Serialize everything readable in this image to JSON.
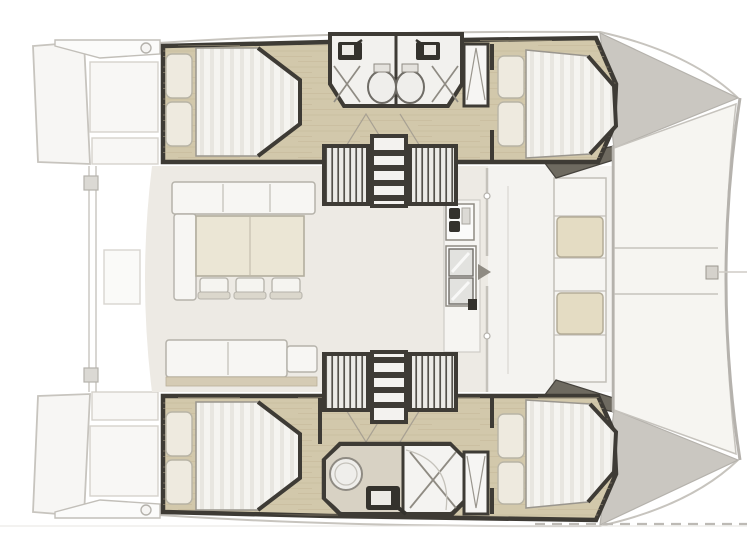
{
  "page": {
    "width": 747,
    "height": 560,
    "background": "#ffffff"
  },
  "palette": {
    "wall": "#3e3b35",
    "wood": "#d2c8ab",
    "room_floor": "#f2f1ee",
    "deck_salon": "#edeae4",
    "fwd_deck_floor": "#f4f3f0",
    "exterior_fill": "#f7f6f4",
    "exterior_line": "#c7c4be",
    "mattress": "#f5f4f0",
    "pillow": "#eeeadf",
    "cushion_fwd": "#e4dcc3",
    "table": "#ebe6d5",
    "bench": "#f7f6f3",
    "bench_back": "#d5cbb4",
    "bow_deck": "#cac7c1",
    "bow_wedge": "#6e6a60",
    "fixture_dark": "#34322d",
    "fixture_light": "#e2e2df",
    "toilet": "#efeeeb",
    "bath_floor_tan": "#d8d2c4",
    "tramp": "#f6f5f1",
    "watermark": "#bdbab5"
  },
  "plan": {
    "type": "catamaran-floor-plan",
    "orientation": "bow pointing right",
    "port_hull": {
      "cabins": [
        "aft double berth",
        "forward double berth"
      ],
      "bathrooms": [
        {
          "fixtures": [
            "sink",
            "toilet",
            "shower"
          ]
        },
        {
          "fixtures": [
            "sink",
            "toilet",
            "shower"
          ]
        }
      ],
      "companionways": 2
    },
    "starboard_hull": {
      "cabins": [
        "aft double berth",
        "forward double berth"
      ],
      "bathrooms": [
        {
          "fixtures": [
            "toilet",
            "sink",
            "shower"
          ]
        }
      ],
      "companionways": 2
    },
    "salon": {
      "furniture": [
        "settee bench",
        "side seat",
        "dining table",
        "3 chairs",
        "aft bench",
        "galley sink unit",
        "galley stove unit",
        "sliding door"
      ]
    },
    "foredeck": {
      "items": [
        "forward cockpit bench",
        "2 seat cushions",
        "trampoline with 3 panels",
        "front crossbeam",
        "2 bow tips"
      ]
    },
    "aft_deck": {
      "items": [
        "2 swim platforms",
        "aft crossbeam",
        "davit bars",
        "winch circles",
        "aft locker"
      ]
    },
    "visible_text": [],
    "watermark": {
      "present": true,
      "legible": false,
      "style": "faint dashed line, bottom edge"
    }
  }
}
